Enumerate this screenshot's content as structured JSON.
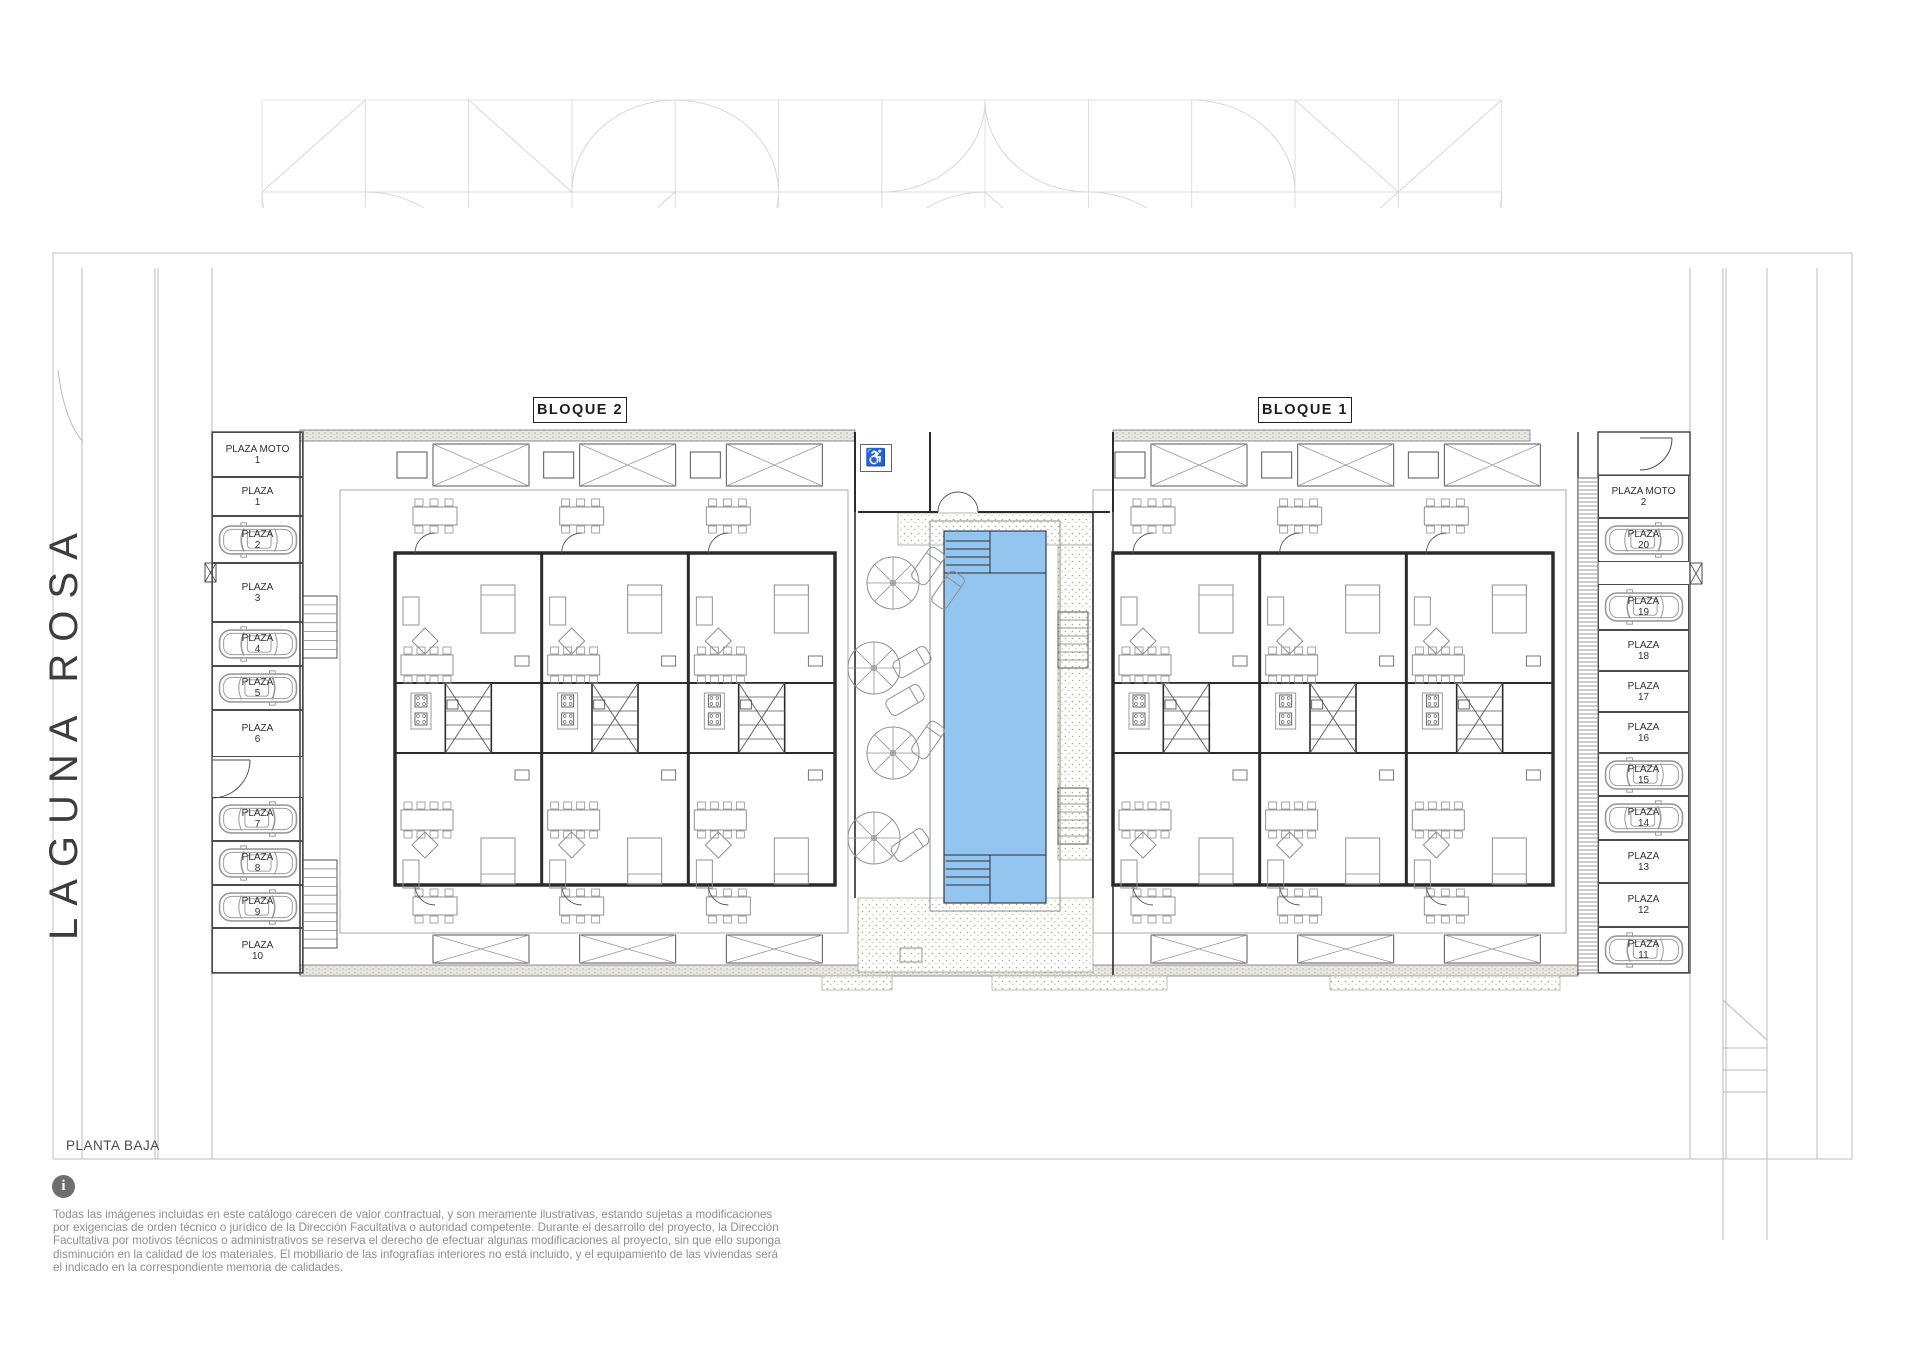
{
  "plan": {
    "title": "PLANTA BAJA",
    "street_name": "LAGUNA ROSA",
    "blocks": [
      {
        "label": "BLOQUE 2"
      },
      {
        "label": "BLOQUE 1"
      }
    ],
    "accessible_glyph": "♿"
  },
  "colors": {
    "pool": "#92c5f0",
    "deck_dot": "#9fae93",
    "wall": "#2b2b2b",
    "furniture": "#909090",
    "site_line": "#c9c9cd",
    "disclaimer_text": "#8e8e8e"
  },
  "parking": {
    "left": [
      {
        "label": "PLAZA MOTO",
        "number": "1",
        "car": false
      },
      {
        "label": "PLAZA",
        "number": "1",
        "car": false
      },
      {
        "label": "PLAZA",
        "number": "2",
        "car": true
      },
      {
        "label": "PLAZA",
        "number": "3",
        "car": false
      },
      {
        "label": "PLAZA",
        "number": "4",
        "car": true
      },
      {
        "label": "PLAZA",
        "number": "5",
        "car": true
      },
      {
        "label": "PLAZA",
        "number": "6",
        "car": false
      },
      {
        "label": "PLAZA",
        "number": "7",
        "car": true
      },
      {
        "label": "PLAZA",
        "number": "8",
        "car": true
      },
      {
        "label": "PLAZA",
        "number": "9",
        "car": true
      },
      {
        "label": "PLAZA",
        "number": "10",
        "car": false
      }
    ],
    "right": [
      {
        "label": "PLAZA MOTO",
        "number": "2",
        "car": false
      },
      {
        "label": "PLAZA",
        "number": "20",
        "car": true
      },
      {
        "label": "PLAZA",
        "number": "19",
        "car": true
      },
      {
        "label": "PLAZA",
        "number": "18",
        "car": false
      },
      {
        "label": "PLAZA",
        "number": "17",
        "car": false
      },
      {
        "label": "PLAZA",
        "number": "16",
        "car": false
      },
      {
        "label": "PLAZA",
        "number": "15",
        "car": true
      },
      {
        "label": "PLAZA",
        "number": "14",
        "car": true
      },
      {
        "label": "PLAZA",
        "number": "13",
        "car": false
      },
      {
        "label": "PLAZA",
        "number": "12",
        "car": false
      },
      {
        "label": "PLAZA",
        "number": "11",
        "car": true
      }
    ]
  },
  "footer": {
    "info_glyph": "i",
    "disclaimer_lines": [
      "Todas las imágenes incluidas en este catálogo carecen de valor contractual, y son meramente ilustrativas, estando sujetas a modificaciones",
      "por exigencias de  orden técnico o jurídico de la Dirección Facultativa o autoridad competente. Durante el desarrollo del proyecto, la Dirección",
      "Facultativa por motivos técnicos o administrativos se reserva el derecho de efectuar algunas modificaciones al proyecto, sin que ello suponga",
      "disminución  en la calidad de los materiales. El mobiliario de las infografías interiores no está incluido, y el equipamiento de las viviendas será",
      "el indicado en la correspondiente memoria de calidades."
    ]
  }
}
